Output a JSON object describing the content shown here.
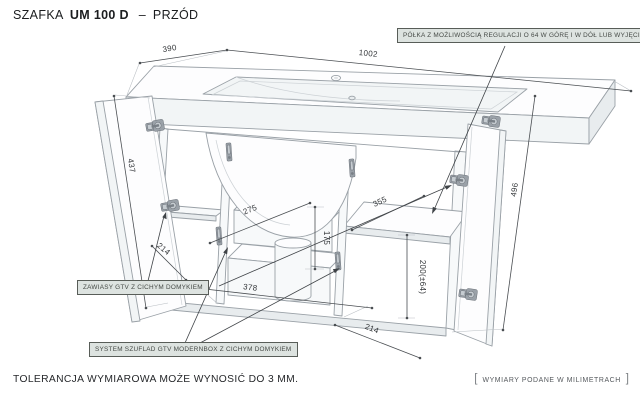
{
  "title": {
    "prefix": "SZAFKA",
    "model": "UM 100 D",
    "separator": "–",
    "view": "PRZÓD"
  },
  "callouts": {
    "shelf": "PÓŁKA Z MOŻLIWOŚCIĄ REGULACJI O 64 W GÓRĘ I W DÓŁ LUB WYJĘCIA",
    "hinges": "ZAWIASY GTV Z CICHYM DOMYKIEM",
    "drawers": "SYSTEM SZUFLAD GTV MODERNBOX Z CICHYM DOMYKIEM"
  },
  "drawing": {
    "dimensions": {
      "top_depth": "390",
      "top_width": "1002",
      "left_door_height": "437",
      "right_side_height": "496",
      "left_door_width": "214",
      "drawer_depth": "275",
      "drawer_front_height": "175",
      "drawer_width": "378",
      "shelf_depth": "355",
      "shelf_clearance": "200(±64)",
      "right_door_width": "214"
    }
  },
  "footer": {
    "tolerance": "TOLERANCJA WYMIAROWA MOŻE WYNOSIĆ DO 3 MM.",
    "units": "WYMIARY PODANE W MILIMETRACH",
    "bracket_open": "[",
    "bracket_close": "]"
  },
  "colors": {
    "background": "#ffffff",
    "drawing_outline": "#9aa1a7",
    "dimension_line": "#4a4e52",
    "callout_fill": "#dde3e0",
    "callout_border": "#585d58",
    "hardware_gray": "#aab1b7",
    "text_dark": "#1b1d1f"
  }
}
